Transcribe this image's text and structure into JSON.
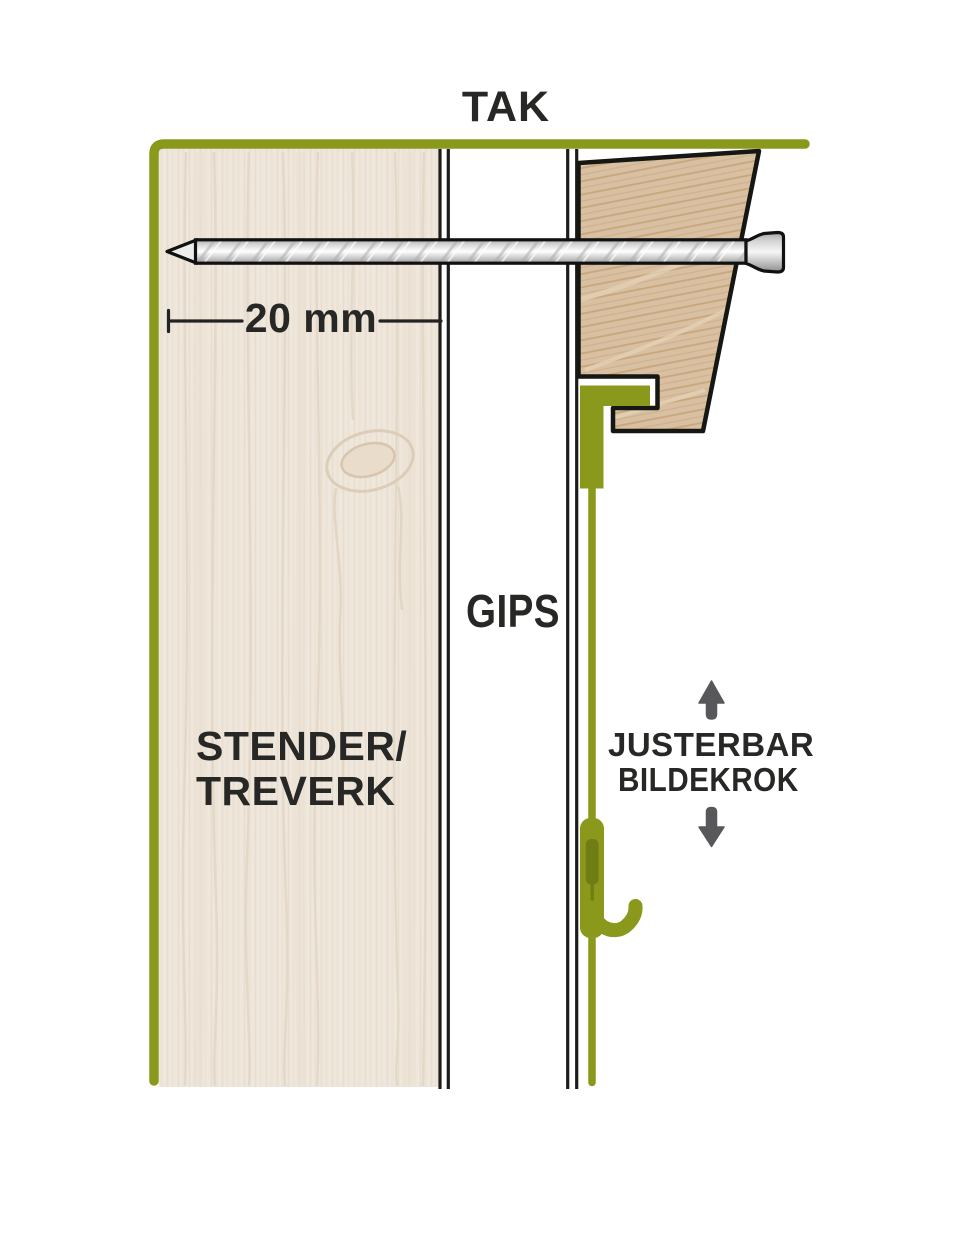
{
  "diagram": {
    "ceiling_label": "TAK",
    "board_label": "GIPS",
    "stud_label_line1": "STENDER/",
    "stud_label_line2": "TREVERK",
    "dimension_label": "20 mm",
    "hook_label_line1": "JUSTERBAR",
    "hook_label_line2": "BILDEKROK"
  },
  "colors": {
    "accent_green": "#8a981c",
    "accent_green_dark": "#6f7d15",
    "label_text": "#272725",
    "arrow_grey": "#58585a",
    "stud_wood_fill": "#efe7dc",
    "molding_wood_fill": "#d9c0a3",
    "outline_black": "#161613"
  },
  "icons": {
    "up_arrow": "up-arrow-icon",
    "down_arrow": "down-arrow-icon"
  }
}
